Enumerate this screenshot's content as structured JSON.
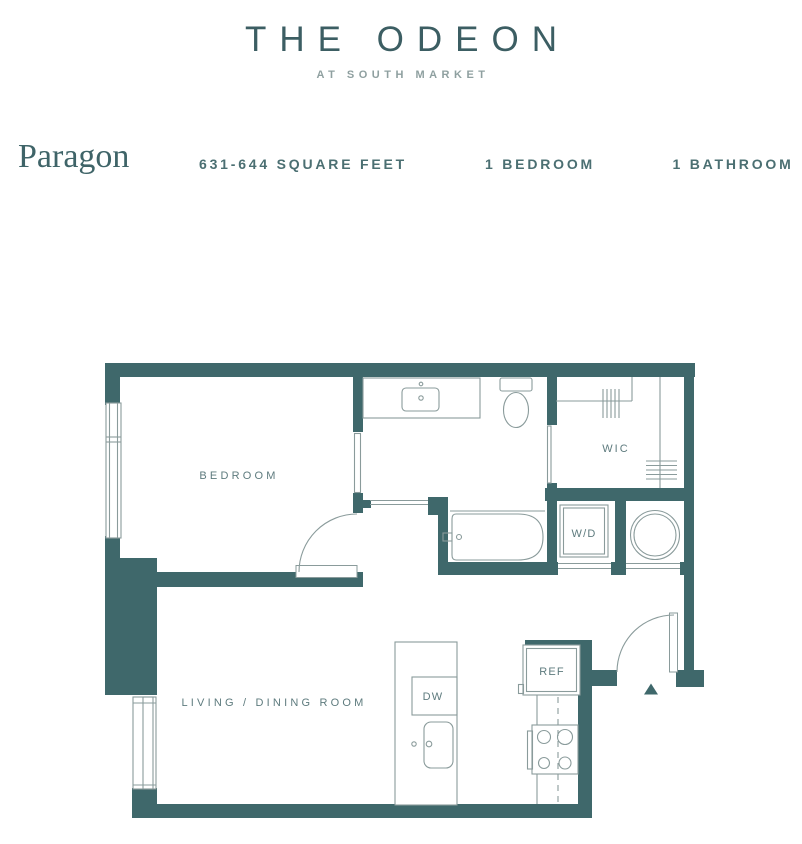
{
  "header": {
    "title": "THE ODEON",
    "subtitle": "AT SOUTH MARKET"
  },
  "specs": {
    "plan_name": "Paragon",
    "square_feet": "631-644 SQUARE FEET",
    "bedrooms": "1 BEDROOM",
    "bathrooms": "1 BATHROOM"
  },
  "floorplan": {
    "room_labels": {
      "bedroom": "BEDROOM",
      "living_dining": "LIVING / DINING ROOM",
      "walk_in_closet": "WIC"
    },
    "fixture_labels": {
      "washer_dryer": "W/D",
      "dishwasher": "DW",
      "refrigerator": "REF"
    }
  },
  "theme": {
    "wall": "#3F686B",
    "line": "#8A9B9B",
    "label": "#5E7B7E",
    "title": "#3C5E63",
    "subtitle": "#8FA0A0",
    "plan_name": "#3F6468",
    "spec": "#4B6F72",
    "bg": "#FFFFFF"
  }
}
